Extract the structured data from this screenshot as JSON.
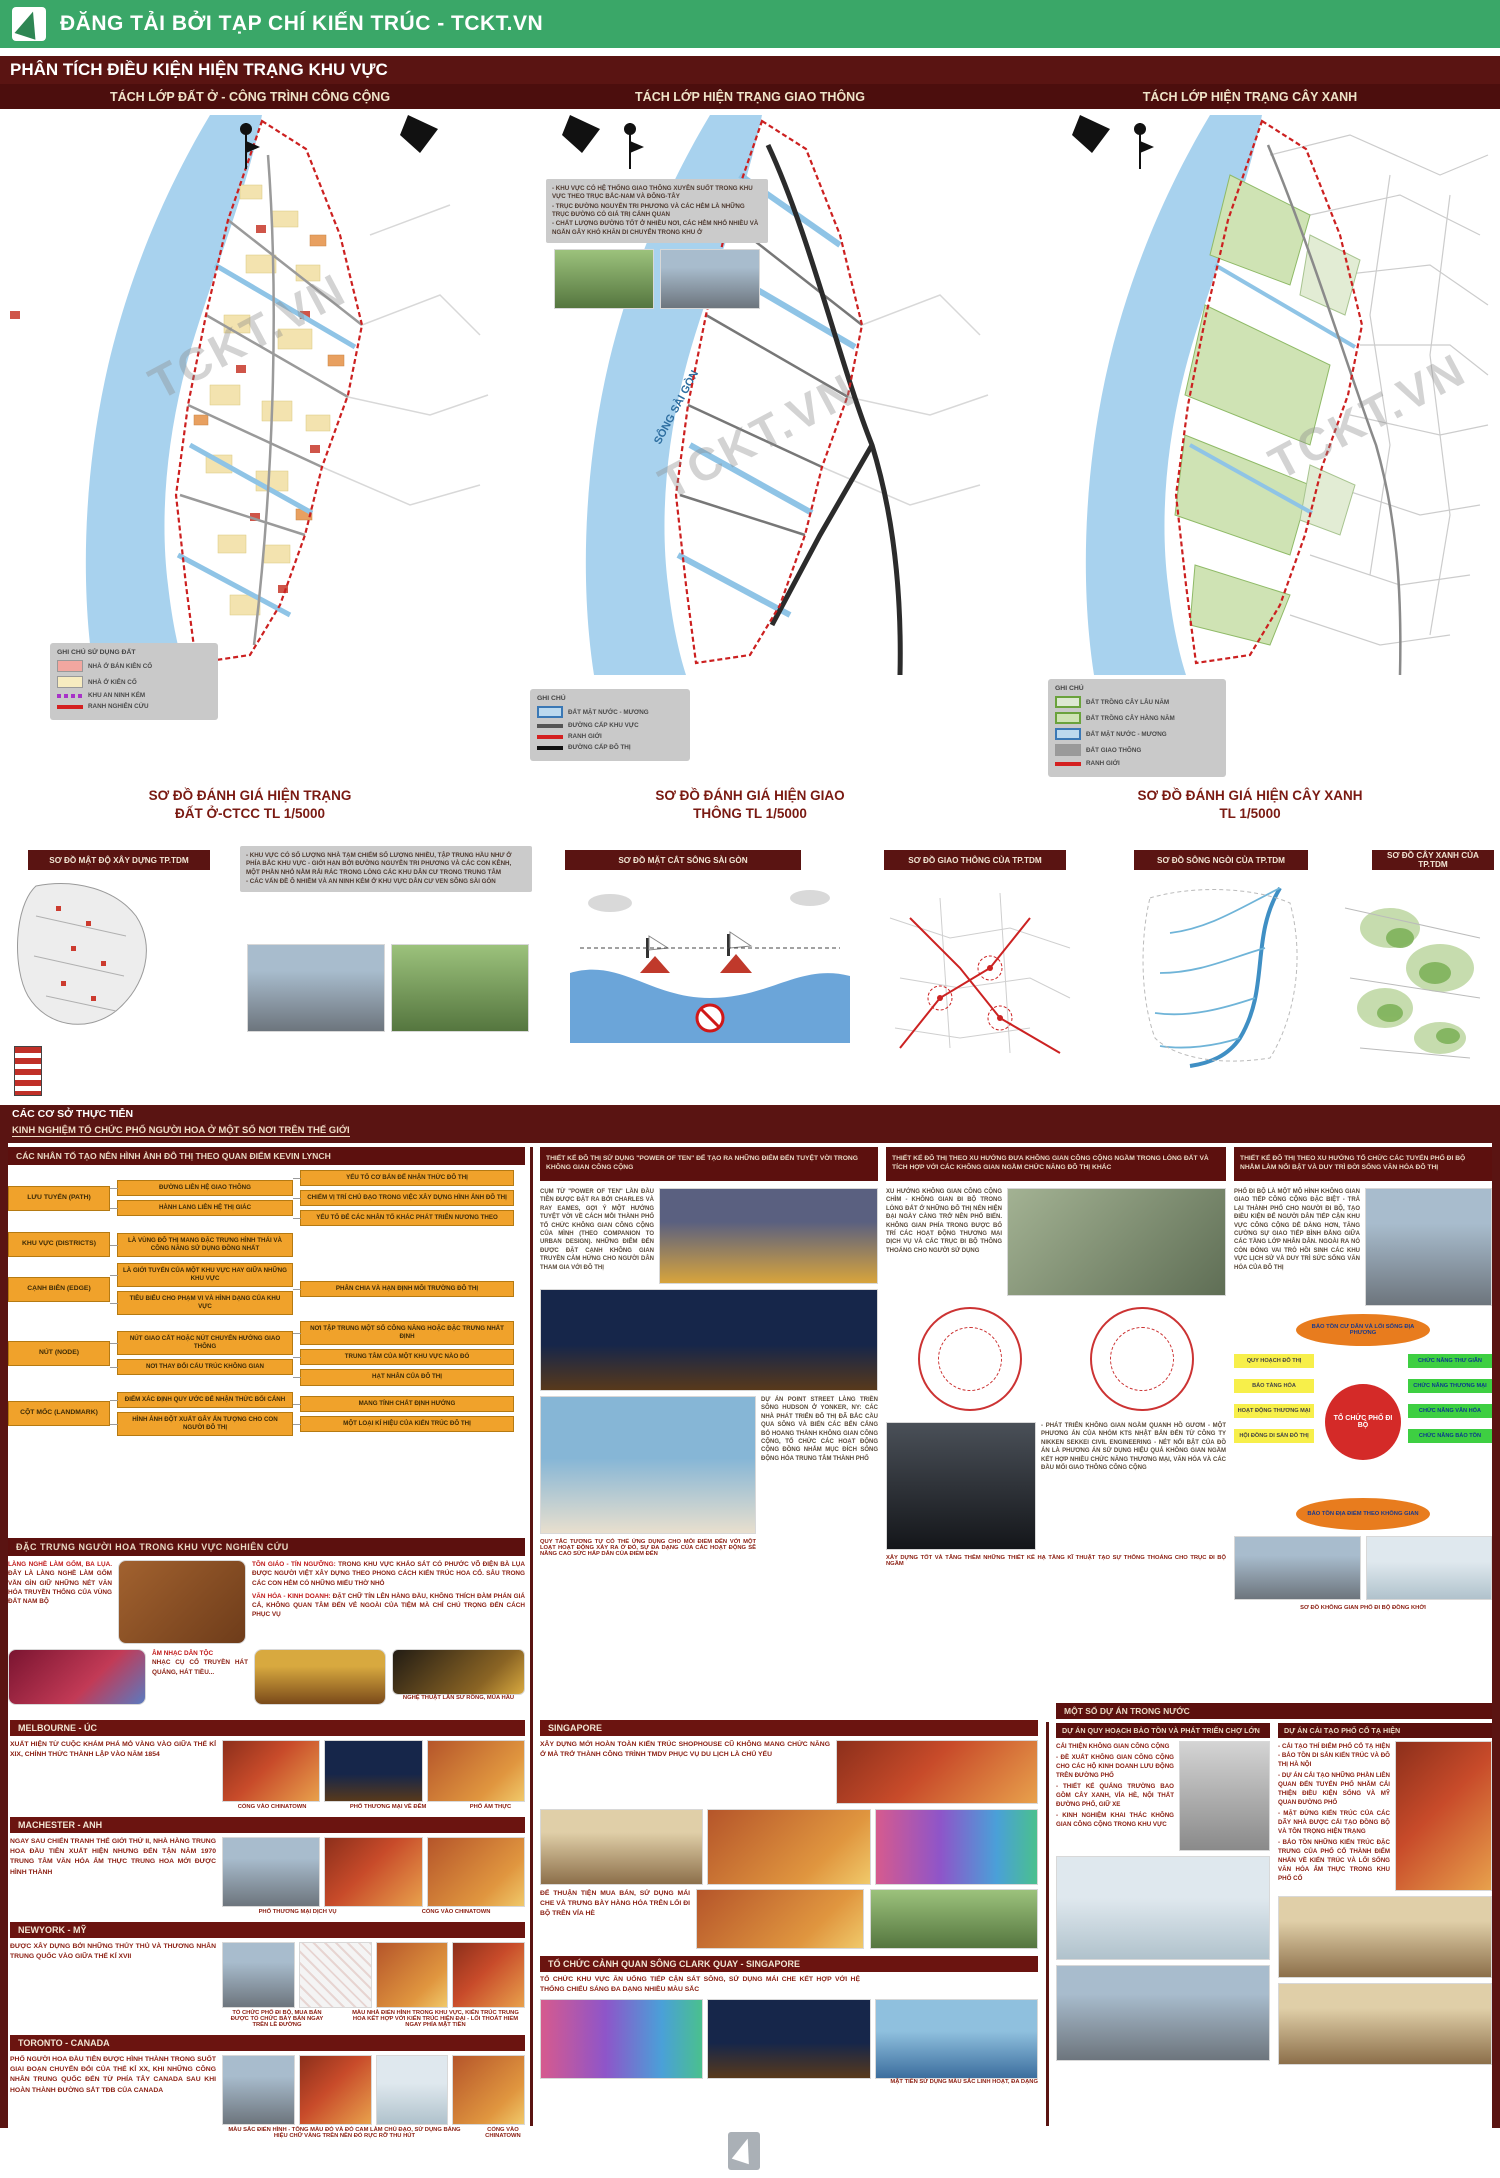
{
  "banner": {
    "text": "ĐĂNG TẢI BỞI TẠP CHÍ KIẾN TRÚC - TCKT.VN"
  },
  "title": "PHÂN TÍCH ĐIỀU KIỆN HIỆN TRẠNG KHU VỰC",
  "tabs": [
    "TÁCH LỚP ĐẤT Ở - CÔNG TRÌNH CÔNG CỘNG",
    "TÁCH LỚP HIỆN TRẠNG GIAO THÔNG",
    "TÁCH LỚP HIỆN TRẠNG CÂY XANH"
  ],
  "watermark": "TCKT.VN",
  "maps": {
    "river_label": "SÔNG SÀI GÒN",
    "land": {
      "legend_title": "GHI CHÚ SỬ DỤNG ĐẤT",
      "legend": [
        {
          "type": "box",
          "color": "#f2a7a0",
          "label": "NHÀ Ở BÁN KIÊN CỐ"
        },
        {
          "type": "box",
          "color": "#f7ecc0",
          "label": "NHÀ Ở KIÊN CỐ"
        },
        {
          "type": "dash",
          "color": "#a832c8",
          "label": "KHU AN NINH KÉM"
        },
        {
          "type": "line",
          "color": "#d42020",
          "label": "RANH NGHIÊN CỨU"
        }
      ],
      "caption": [
        "SƠ ĐỒ ĐÁNH GIÁ HIỆN TRẠNG",
        "ĐẤT Ở-CTCC TL 1/5000"
      ]
    },
    "traffic": {
      "notes": [
        "- KHU VỰC CÓ HỆ THỐNG GIAO THÔNG XUYÊN SUỐT TRONG KHU VỰC THEO TRỤC BẮC-NAM VÀ ĐÔNG-TÂY",
        "- TRỤC ĐƯỜNG NGUYỄN TRI PHƯƠNG VÀ CÁC HẺM LÀ NHỮNG TRỤC ĐƯỜNG CÓ GIÁ TRỊ CẢNH QUAN",
        "- CHẤT LƯỢNG ĐƯỜNG TỐT Ở NHIỀU NƠI, CÁC HẺM NHỎ NHIỀU VÀ NGẮN GÂY KHÓ KHĂN DI CHUYỂN TRONG KHU Ở"
      ],
      "legend_title": "GHI CHÚ",
      "legend": [
        {
          "type": "box-blue-border",
          "color": "#bcd9ee",
          "label": "ĐẤT MẶT NƯỚC - MƯƠNG"
        },
        {
          "type": "line",
          "color": "#555555",
          "label": "ĐƯỜNG CẤP KHU VỰC"
        },
        {
          "type": "line",
          "color": "#d42020",
          "label": "RANH GIỚI"
        },
        {
          "type": "line",
          "color": "#111111",
          "label": "ĐƯỜNG CẤP ĐÔ THỊ"
        }
      ],
      "caption": [
        "SƠ ĐỒ ĐÁNH GIÁ HIỆN GIAO",
        "THÔNG TL 1/5000"
      ]
    },
    "green": {
      "legend_title": "GHI CHÚ",
      "legend": [
        {
          "type": "box-green-border",
          "color": "#dde8d2",
          "label": "ĐẤT TRỒNG CÂY LÂU NĂM"
        },
        {
          "type": "box-green-border",
          "color": "#cfe3b4",
          "label": "ĐẤT TRỒNG CÂY HÀNG NĂM"
        },
        {
          "type": "box-blue-border",
          "color": "#bcd9ee",
          "label": "ĐẤT MẶT NƯỚC - MƯƠNG"
        },
        {
          "type": "box",
          "color": "#9a9a9a",
          "label": "ĐẤT GIAO THÔNG"
        },
        {
          "type": "line",
          "color": "#d42020",
          "label": "RANH GIỚI"
        }
      ],
      "caption": [
        "SƠ ĐỒ ĐÁNH GIÁ HIỆN CÂY XANH",
        "TL 1/5000"
      ]
    }
  },
  "diagrams": {
    "d1": "SƠ ĐỒ MẬT ĐỘ XÂY DỰNG TP.TDM",
    "d1_notes": [
      "- KHU VỰC CÓ SỐ LƯỢNG NHÀ TẠM CHIẾM SỐ LƯỢNG NHIỀU, TẬP TRUNG HẦU NHƯ Ở PHÍA BẮC KHU VỰC - GIỚI HẠN BỞI ĐƯỜNG NGUYỄN TRI PHƯƠNG VÀ CÁC CON KÊNH, MỘT PHẦN NHỎ NẰM RẢI RÁC TRONG LÒNG CÁC KHU DÂN CƯ TRONG TRUNG TÂM",
      "- CÁC VẤN ĐỀ Ô NHIỄM VÀ AN NINH KÉM Ở KHU VỰC DÂN CƯ VEN SÔNG SÀI GÒN"
    ],
    "d2": "SƠ ĐỒ MẶT CẮT SÔNG SÀI GÒN",
    "d3": "SƠ ĐỒ GIAO THÔNG CỦA TP.TDM",
    "d4": "SƠ ĐỒ SÔNG NGÒI CỦA TP.TDM",
    "d5": "SƠ ĐỒ CÂY XANH CỦA TP.TDM"
  },
  "practice": {
    "line1": "CÁC CƠ SỞ THỰC TIỄN",
    "line2": "KINH NGHIỆM TỔ CHỨC PHỐ NGƯỜI HOA Ở MỘT SỐ NƠI TRÊN THẾ GIỚI"
  },
  "lynch": {
    "header": "CÁC NHÂN TỐ TẠO NÊN HÌNH ẢNH ĐÔ THỊ THEO QUAN ĐIỂM KEVIN LYNCH",
    "rows": [
      {
        "root": "LƯU TUYẾN (PATH)",
        "mid": [
          "ĐƯỜNG LIÊN HỆ GIAO THÔNG",
          "HÀNH LANG LIÊN HỆ THỊ GIÁC"
        ],
        "leaf": [
          "YẾU TỐ CƠ BẢN ĐỂ NHẬN THỨC ĐÔ THỊ",
          "CHIẾM VỊ TRÍ CHỦ ĐẠO TRONG VIỆC XÂY DỰNG HÌNH ẢNH ĐÔ THỊ",
          "YẾU TỐ ĐỂ CÁC NHÂN TỐ KHÁC PHÁT TRIỂN NƯƠNG THEO"
        ]
      },
      {
        "root": "KHU VỰC (DISTRICTS)",
        "mid": [
          "LÀ VÙNG ĐÔ THỊ MANG ĐẶC TRƯNG HÌNH THÁI VÀ CÔNG NĂNG SỬ DỤNG ĐỒNG NHẤT"
        ],
        "leaf": []
      },
      {
        "root": "CẠNH BIÊN (EDGE)",
        "mid": [
          "LÀ GIỚI TUYẾN CỦA MỘT KHU VỰC HAY GIỮA NHỮNG KHU VỰC",
          "TIÊU BIỂU CHO PHẠM VI VÀ HÌNH DẠNG CỦA KHU VỰC"
        ],
        "leaf": [
          "PHÂN CHIA VÀ HẠN ĐỊNH MÔI TRƯỜNG ĐÔ THỊ"
        ]
      },
      {
        "root": "NÚT (NODE)",
        "mid": [
          "NÚT GIAO CẮT HOẶC NÚT CHUYỂN HƯỚNG GIAO THÔNG",
          "NƠI THAY ĐỔI CẤU TRÚC KHÔNG GIAN"
        ],
        "leaf": [
          "NƠI TẬP TRUNG MỘT SỐ CÔNG NĂNG HOẶC ĐẶC TRƯNG NHẤT ĐỊNH",
          "TRUNG TÂM CỦA MỘT KHU VỰC NÀO ĐÓ",
          "HẠT NHÂN CỦA ĐÔ THỊ"
        ]
      },
      {
        "root": "CỘT MỐC (LANDMARK)",
        "mid": [
          "ĐIỂM XÁC ĐỊNH QUY ƯỚC ĐỂ NHẬN THỨC BỐI CẢNH",
          "HÌNH ẢNH ĐỘT XUẤT GÂY ẤN TƯỢNG CHO CON NGƯỜI ĐÔ THỊ"
        ],
        "leaf": [
          "MANG TÍNH CHẤT ĐỊNH HƯỚNG",
          "MỘT LOẠI KÍ HIỆU CỦA KIẾN TRÚC ĐÔ THỊ"
        ]
      }
    ]
  },
  "hoa": {
    "header": "ĐẶC TRƯNG NGƯỜI HOA TRONG KHU VỰC NGHIÊN CỨU",
    "craft_title": "LÀNG NGHỀ LÀM GỐM, BA LỤA.",
    "craft_text": "ĐÂY LÀ LÀNG NGHỀ LÀM GỐM VẪN GÌN GIỮ NHỮNG NÉT VĂN HÓA TRUYỀN THỐNG CỦA VÙNG ĐẤT NAM BỘ",
    "religion_title": "TÔN GIÁO - TÍN NGƯỠNG:",
    "religion_text": "TRONG KHU VỰC KHẢO SÁT CÓ PHƯỚC VÕ ĐIỆN BÀ LỤA ĐƯỢC NGƯỜI VIỆT XÂY DỰNG THEO PHONG CÁCH KIẾN TRÚC HOA CỔ. SÂU TRONG CÁC CON HẺM CÓ NHỮNG MIẾU THỜ NHỎ",
    "trade_title": "VĂN HÓA - KINH DOANH:",
    "trade_text": "ĐẶT CHỮ TÍN LÊN HÀNG ĐẦU, KHÔNG THÍCH ĐÀM PHÁN GIÁ CẢ, KHÔNG QUAN TÂM ĐẾN VẺ NGOÀI CỦA TIỆM MÀ CHỈ CHÚ TRỌNG ĐẾN CÁCH PHỤC VỤ",
    "music_title": "ÂM NHẠC DÂN TỘC",
    "music_text": "NHẠC CỤ CỔ TRUYỀN HÁT QUẢNG, HÁT TIỀU...",
    "lion_caption": "NGHỆ THUẬT LÂN SƯ RỒNG, MÚA HẦU"
  },
  "trends": [
    {
      "header": "THIẾT KẾ ĐÔ THỊ SỬ DỤNG \"POWER OF TEN\" ĐỂ TẠO RA NHỮNG ĐIỂM ĐẾN TUYỆT VỜI TRONG KHÔNG GIAN CÔNG CỘNG",
      "para1": "CỤM TỪ \"POWER OF TEN\" LẦN ĐẦU TIÊN ĐƯỢC ĐẶT RA BỞI CHARLES VÀ RAY EAMES, GỢI Ý MỘT HƯỚNG TUYỆT VỜI VỀ CÁCH MỖI THÀNH PHỐ TỔ CHỨC KHÔNG GIAN CÔNG CỘNG CỦA MÌNH (THEO COMPANION TO URBAN DESIGN). NHỮNG ĐIỂM ĐẾN ĐƯỢC ĐẶT CẠNH KHÔNG GIAN TRUYỀN CẢM HỨNG CHO NGƯỜI DÂN THAM GIA VỚI ĐÔ THỊ",
      "para2": "DỰ ÁN POINT STREET LÀNG TRIỀN SÔNG HUDSON Ở YONKER, NY: CÁC NHÀ PHÁT TRIỂN ĐÔ THỊ ĐÃ BẮC CẦU QUA SÔNG VÀ BIẾN CÁC BẾN CẢNG BỎ HOANG THÀNH KHÔNG GIAN CÔNG CỘNG, TỔ CHỨC CÁC HOẠT ĐỘNG CỘNG ĐỒNG NHẰM MỤC ĐÍCH SỐNG ĐỘNG HÓA TRUNG TÂM THÀNH PHỐ",
      "caption": "QUY TẮC TƯƠNG TỰ CÓ THỂ ỨNG DỤNG CHO MỖI ĐIỂM ĐẾN VỚI MỘT LOẠT HOẠT ĐỘNG XẢY RA Ở ĐÓ, SỰ ĐA DẠNG CỦA CÁC HOẠT ĐỘNG SẼ NÂNG CAO SỨC HẤP DẪN CỦA ĐIỂM ĐẾN"
    },
    {
      "header": "THIẾT KẾ ĐÔ THỊ THEO XU HƯỚNG ĐƯA KHÔNG GIAN CÔNG CỘNG NGẦM TRONG LÒNG ĐẤT VÀ TÍCH HỢP VỚI CÁC KHÔNG GIAN NGẦM CHỨC NĂNG ĐÔ THỊ KHÁC",
      "para1": "XU HƯỚNG KHÔNG GIAN CÔNG CỘNG CHÌM - KHÔNG GIAN ĐI BỘ TRONG LÒNG ĐẤT Ở NHỮNG ĐÔ THỊ NÉN HIỆN ĐẠI NGÀY CÀNG TRỞ NÊN PHỔ BIẾN. KHÔNG GIAN PHÍA TRONG ĐƯỢC BỐ TRÍ CÁC HOẠT ĐỘNG THƯƠNG MẠI DỊCH VỤ VÀ CÁC TRỤC ĐI BỘ THÔNG THOÁNG CHO NGƯỜI SỬ DỤNG",
      "para2": "- PHÁT TRIỂN KHÔNG GIAN NGẦM QUANH HỒ GƯƠM - MỘT PHƯƠNG ÁN CỦA NHÓM KTS NHẬT BẢN ĐẾN TỪ CÔNG TY NIKKEN SEKKEI CIVIL ENGINEERING - NÉT NỔI BẬT CỦA ĐỒ ÁN LÀ PHƯƠNG ÁN SỬ DỤNG HIỆU QUẢ KHÔNG GIAN NGẦM KẾT HỢP NHIỀU CHỨC NĂNG THƯƠNG MẠI, VĂN HÓA VÀ CÁC ĐẦU MỐI GIAO THÔNG CÔNG CỘNG",
      "caption": "XÂY DỰNG TỐT VÀ TĂNG THÊM NHỮNG THIẾT KẾ HẠ TẦNG KĨ THUẬT TẠO SỰ THÔNG THOÁNG CHO TRỤC ĐI BỘ NGẦM"
    },
    {
      "header": "THIẾT KẾ ĐÔ THỊ THEO XU HƯỚNG TỔ CHỨC CÁC TUYẾN PHỐ ĐI BỘ NHẰM LÀM NỔI BẬT VÀ DUY TRÌ ĐỜI SỐNG VĂN HÓA ĐÔ THỊ",
      "para1": "PHỐ ĐI BỘ LÀ MỘT MÔ HÌNH KHÔNG GIAN GIAO TIẾP CÔNG CỘNG ĐẶC BIỆT - TRẢ LẠI THÀNH PHỐ CHO NGƯỜI ĐI BỘ, TẠO ĐIỀU KIỆN ĐỂ NGƯỜI DÂN TIẾP CẬN KHU VỰC CÔNG CỘNG DỄ DÀNG HƠN, TĂNG CƯỜNG SỰ GIAO TIẾP BÌNH ĐẲNG GIỮA CÁC TẦNG LỚP NHÂN DÂN. NGOÀI RA NÓ CÒN ĐÓNG VAI TRÒ HỒI SINH CÁC KHU VỰC LỊCH SỬ VÀ DUY TRÌ SỨC SỐNG VĂN HÓA CỦA ĐÔ THỊ",
      "caption": "SƠ ĐỒ KHÔNG GIAN PHỐ ĐI BỘ ĐỒNG KHỞI"
    }
  ],
  "radial": {
    "top": "BẢO TỒN CƯ DÂN VÀ LỐI SỐNG ĐỊA PHƯƠNG",
    "bottom": "BẢO TỒN ĐỊA ĐIỂM THEO KHÔNG GIAN",
    "center": "TỔ CHỨC PHỐ ĐI BỘ",
    "left": [
      "QUY HOẠCH ĐÔ THỊ",
      "BẢO TÀNG HÓA",
      "HOẠT ĐỘNG THƯƠNG MẠI",
      "HỘI ĐỒNG DI SẢN ĐÔ THỊ"
    ],
    "right": [
      "CHỨC NĂNG THƯ GIÃN",
      "CHỨC NĂNG THƯƠNG MẠI",
      "CHỨC NĂNG VĂN HÓA",
      "CHỨC NĂNG BẢO TỒN"
    ]
  },
  "cities": [
    {
      "title": "MELBOURNE - ÚC",
      "text": "XUẤT HIỆN TỪ CUỘC KHÁM PHÁ MỎ VÀNG VÀO GIỮA THẾ KỈ XIX, CHÍNH THỨC THÀNH LẬP VÀO NĂM 1854",
      "captions": [
        "CỔNG VÀO CHINATOWN",
        "PHỐ THƯƠNG MẠI VỀ ĐÊM",
        "PHỐ ẨM THỰC"
      ]
    },
    {
      "title": "MACHESTER - ANH",
      "text": "NGAY SAU CHIẾN TRANH THẾ GIỚI THỨ II, NHÀ HÀNG TRUNG HOA ĐẦU TIÊN XUẤT HIỆN NHƯNG ĐẾN TẬN NĂM 1970 TRUNG TÂM VĂN HÓA ẨM THỰC TRUNG HOA MỚI ĐƯỢC HÌNH THÀNH",
      "captions": [
        "PHỐ THƯƠNG MẠI DỊCH VỤ",
        "CỔNG VÀO CHINATOWN"
      ]
    },
    {
      "title": "NEWYORK - MỸ",
      "text": "ĐƯỢC XÂY DỰNG BỞI NHỮNG THỦY THỦ VÀ THƯƠNG NHÂN TRUNG QUỐC VÀO GIỮA THẾ KỈ XVII",
      "captions": [
        "TỔ CHỨC PHỐ ĐI BỘ, MUA BÁN ĐƯỢC TỔ CHỨC BÀY BÁN NGAY TRÊN LỀ ĐƯỜNG",
        "MÀU NHÀ ĐIỂN HÌNH TRONG KHU VỰC, KIẾN TRÚC TRUNG HOA KẾT HỢP VỚI KIẾN TRÚC HIỆN ĐẠI - LỐI THOÁT HIỂM NGAY PHÍA MẶT TIỀN"
      ]
    },
    {
      "title": "TORONTO - CANADA",
      "text": "PHỐ NGƯỜI HOA ĐẦU TIÊN ĐƯỢC HÌNH THÀNH TRONG SUỐT GIAI ĐOẠN CHUYỂN ĐỔI CỦA THẾ KỈ XX, KHI NHỮNG CÔNG NHÂN TRUNG QUỐC ĐẾN TỪ PHÍA TÂY CANADA SAU KHI HOÀN THÀNH ĐƯỜNG SẮT TĐB CỦA CANADA",
      "captions": [
        "MÀU SẮC ĐIỂN HÌNH - TÔNG MÀU ĐỎ VÀ ĐỎ CAM LÀM CHỦ ĐẠO, SỬ DỤNG BẢNG HIỆU CHỮ VÀNG TRÊN NỀN ĐỎ RỰC RỠ THU HÚT",
        "CỔNG VÀO CHINATOWN"
      ]
    }
  ],
  "singapore": {
    "title": "SINGAPORE",
    "text1": "XÂY DỰNG MỚI HOÀN TOÀN KIẾN TRÚC SHOPHOUSE CŨ KHÔNG MANG CHỨC NĂNG Ở MÀ TRỞ THÀNH CÔNG TRÌNH TMDV PHỤC VỤ DU LỊCH LÀ CHỦ YẾU",
    "text2": "ĐỂ THUẬN TIỆN MUA BÁN, SỬ DỤNG MÁI CHE VÀ TRƯNG BÀY HÀNG HÓA TRÊN LỐI ĐI BỘ TRÊN VỈA HÈ"
  },
  "clark": {
    "title": "TỔ CHỨC CẢNH QUAN SÔNG CLARK QUAY - SINGAPORE",
    "text": "TỔ CHỨC KHU VỰC ĂN UỐNG TIẾP CẬN SÁT SÔNG, SỬ DỤNG MÁI CHE KẾT HỢP VỚI HỆ THỐNG CHIẾU SÁNG ĐA DẠNG NHIỀU MÀU SẮC",
    "caption": "MẶT TIỀN SỬ DỤNG MÀU SẮC LINH HOẠT, ĐA DẠNG"
  },
  "domestic": {
    "header": "MỘT SỐ DỰ ÁN TRONG NƯỚC",
    "p1": {
      "title": "DỰ ÁN QUY HOẠCH BẢO TỒN VÀ PHÁT TRIỂN CHỢ LỚN",
      "lines": [
        "CẢI THIỆN KHÔNG GIAN CÔNG CỘNG",
        "- ĐỀ XUẤT KHÔNG GIAN CÔNG CỘNG CHO CÁC HỘ KINH DOANH LƯU ĐỘNG TRÊN ĐƯỜNG PHỐ",
        "- THIẾT KẾ QUẢNG TRƯỜNG BAO GỒM CÂY XANH, VỈA HÈ, NỘI THẤT ĐƯỜNG PHỐ, GIỮ XE",
        "- KINH NGHIỆM KHAI THÁC KHÔNG GIAN CÔNG CỘNG TRONG KHU VỰC"
      ]
    },
    "p2": {
      "title": "DỰ ÁN CẢI TẠO PHỐ CỔ TẠ HIỆN",
      "lines": [
        "- CẢI TẠO THÍ ĐIỂM PHỐ CỔ TẠ HIỆN - BẢO TỒN DI SẢN KIẾN TRÚC VÀ ĐÔ THỊ HÀ NỘI",
        "- DỰ ÁN CẢI TẠO NHỮNG PHẦN LIÊN QUAN ĐẾN TUYẾN PHỐ NHẰM CẢI THIỆN ĐIỀU KIỆN SỐNG VÀ MỸ QUAN ĐƯỜNG PHỐ",
        "- MẶT ĐỨNG KIẾN TRÚC CỦA CÁC DÃY NHÀ ĐƯỢC CẢI TẠO ĐỒNG BỘ VÀ TÔN TRỌNG HIỆN TRẠNG",
        "- BẢO TỒN NHỮNG KIẾN TRÚC ĐẶC TRƯNG CỦA PHỐ CỔ THÀNH ĐIỂM NHẤN VỀ KIẾN TRÚC VÀ LỐI SỐNG VĂN HÓA ẨM THỰC TRONG KHU PHỐ CỔ"
      ]
    }
  }
}
